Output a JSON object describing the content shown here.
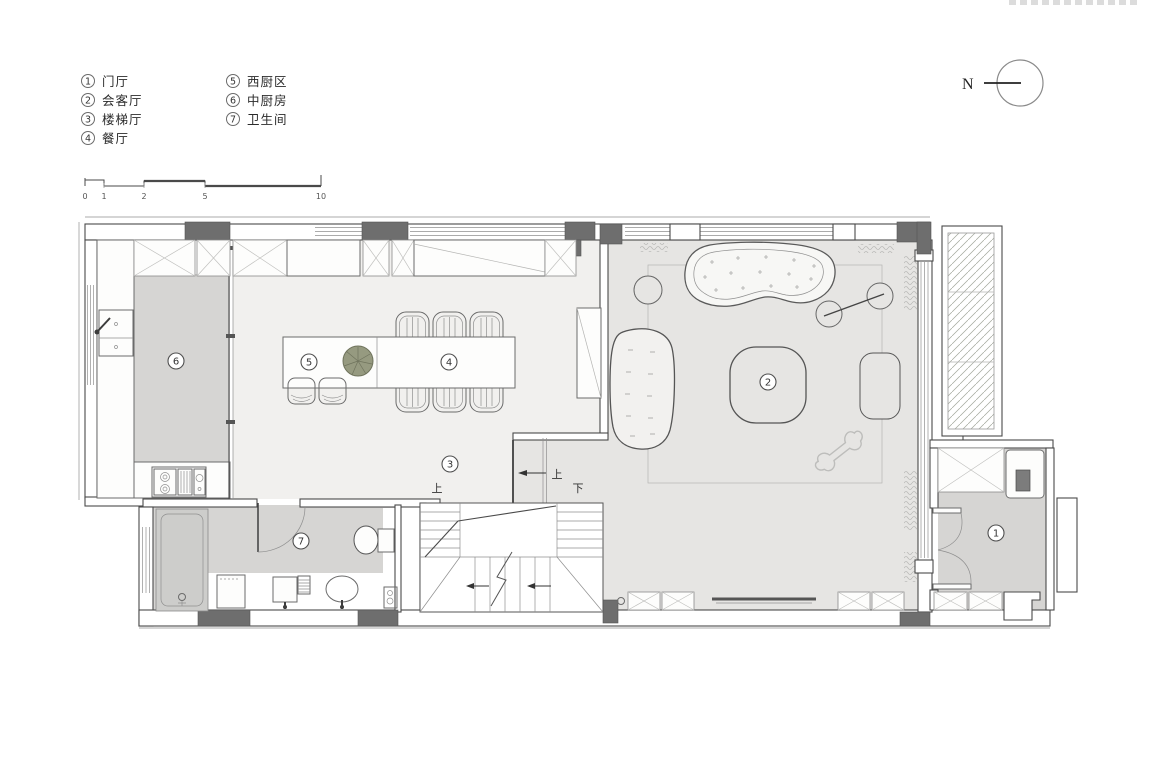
{
  "legend": {
    "items": [
      {
        "num": "1",
        "label": "门厅"
      },
      {
        "num": "2",
        "label": "会客厅"
      },
      {
        "num": "3",
        "label": "楼梯厅"
      },
      {
        "num": "4",
        "label": "餐厅"
      },
      {
        "num": "5",
        "label": "西厨区"
      },
      {
        "num": "6",
        "label": "中厨房"
      },
      {
        "num": "7",
        "label": "卫生间"
      }
    ]
  },
  "scale_bar": {
    "ticks": [
      "0",
      "1",
      "2",
      "5",
      "10"
    ]
  },
  "north_arrow": {
    "label": "N"
  },
  "plan": {
    "room_markers": [
      {
        "num": "1"
      },
      {
        "num": "2"
      },
      {
        "num": "3"
      },
      {
        "num": "4"
      },
      {
        "num": "5"
      },
      {
        "num": "6"
      },
      {
        "num": "7"
      }
    ],
    "stair_labels": {
      "up_left": "上",
      "up_corridor": "上",
      "down": "下"
    }
  },
  "colors": {
    "floor_light": "#f1f0ee",
    "floor_living": "#e6e5e3",
    "floor_service": "#d6d5d3",
    "wall": "#4a4a4a",
    "column": "#6e6e6e",
    "plant": "#969a80"
  }
}
